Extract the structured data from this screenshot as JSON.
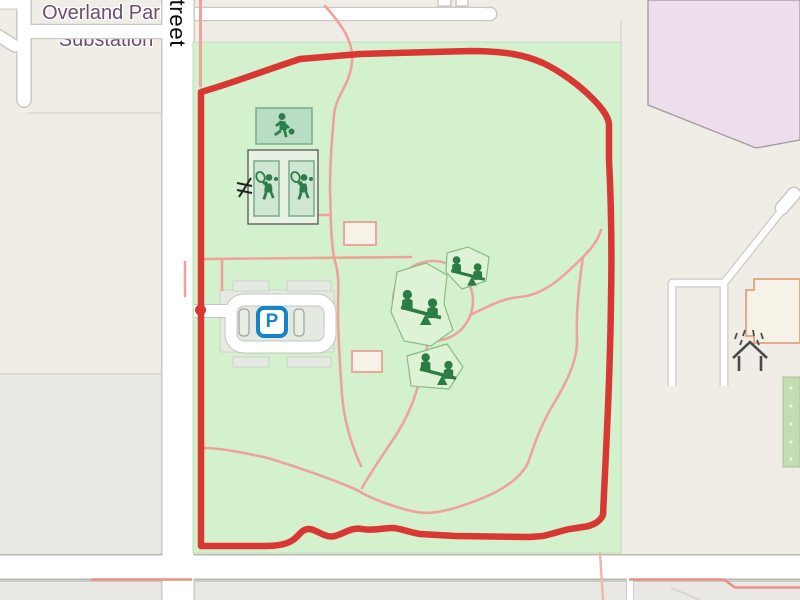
{
  "map": {
    "street_label": "Street",
    "area_label": {
      "line1": "Overland Park",
      "line2": "Substation"
    },
    "parking_label": "P",
    "features": {
      "park": "city park with running track loop",
      "poi_icons": [
        "basketball-player-icon",
        "tennis-player-icon",
        "seesaw-playground-icon",
        "parking-icon",
        "gate-icon",
        "picnic-shelter-icon"
      ]
    },
    "colors": {
      "route_red": "#d93733",
      "path_pink": "#efa29a",
      "park_green": "#d4f1ce",
      "pitch_green": "#b9dcc5",
      "icon_green": "#2b7d44",
      "parking_blue": "#1585c8",
      "substation_fill": "#ecdeea",
      "substation_text": "#6d4c6c",
      "road_white": "#ffffff",
      "road_casing": "#ccc9c2",
      "block_beige": "#f0ede7",
      "block_gray": "#e9e8e4"
    }
  }
}
